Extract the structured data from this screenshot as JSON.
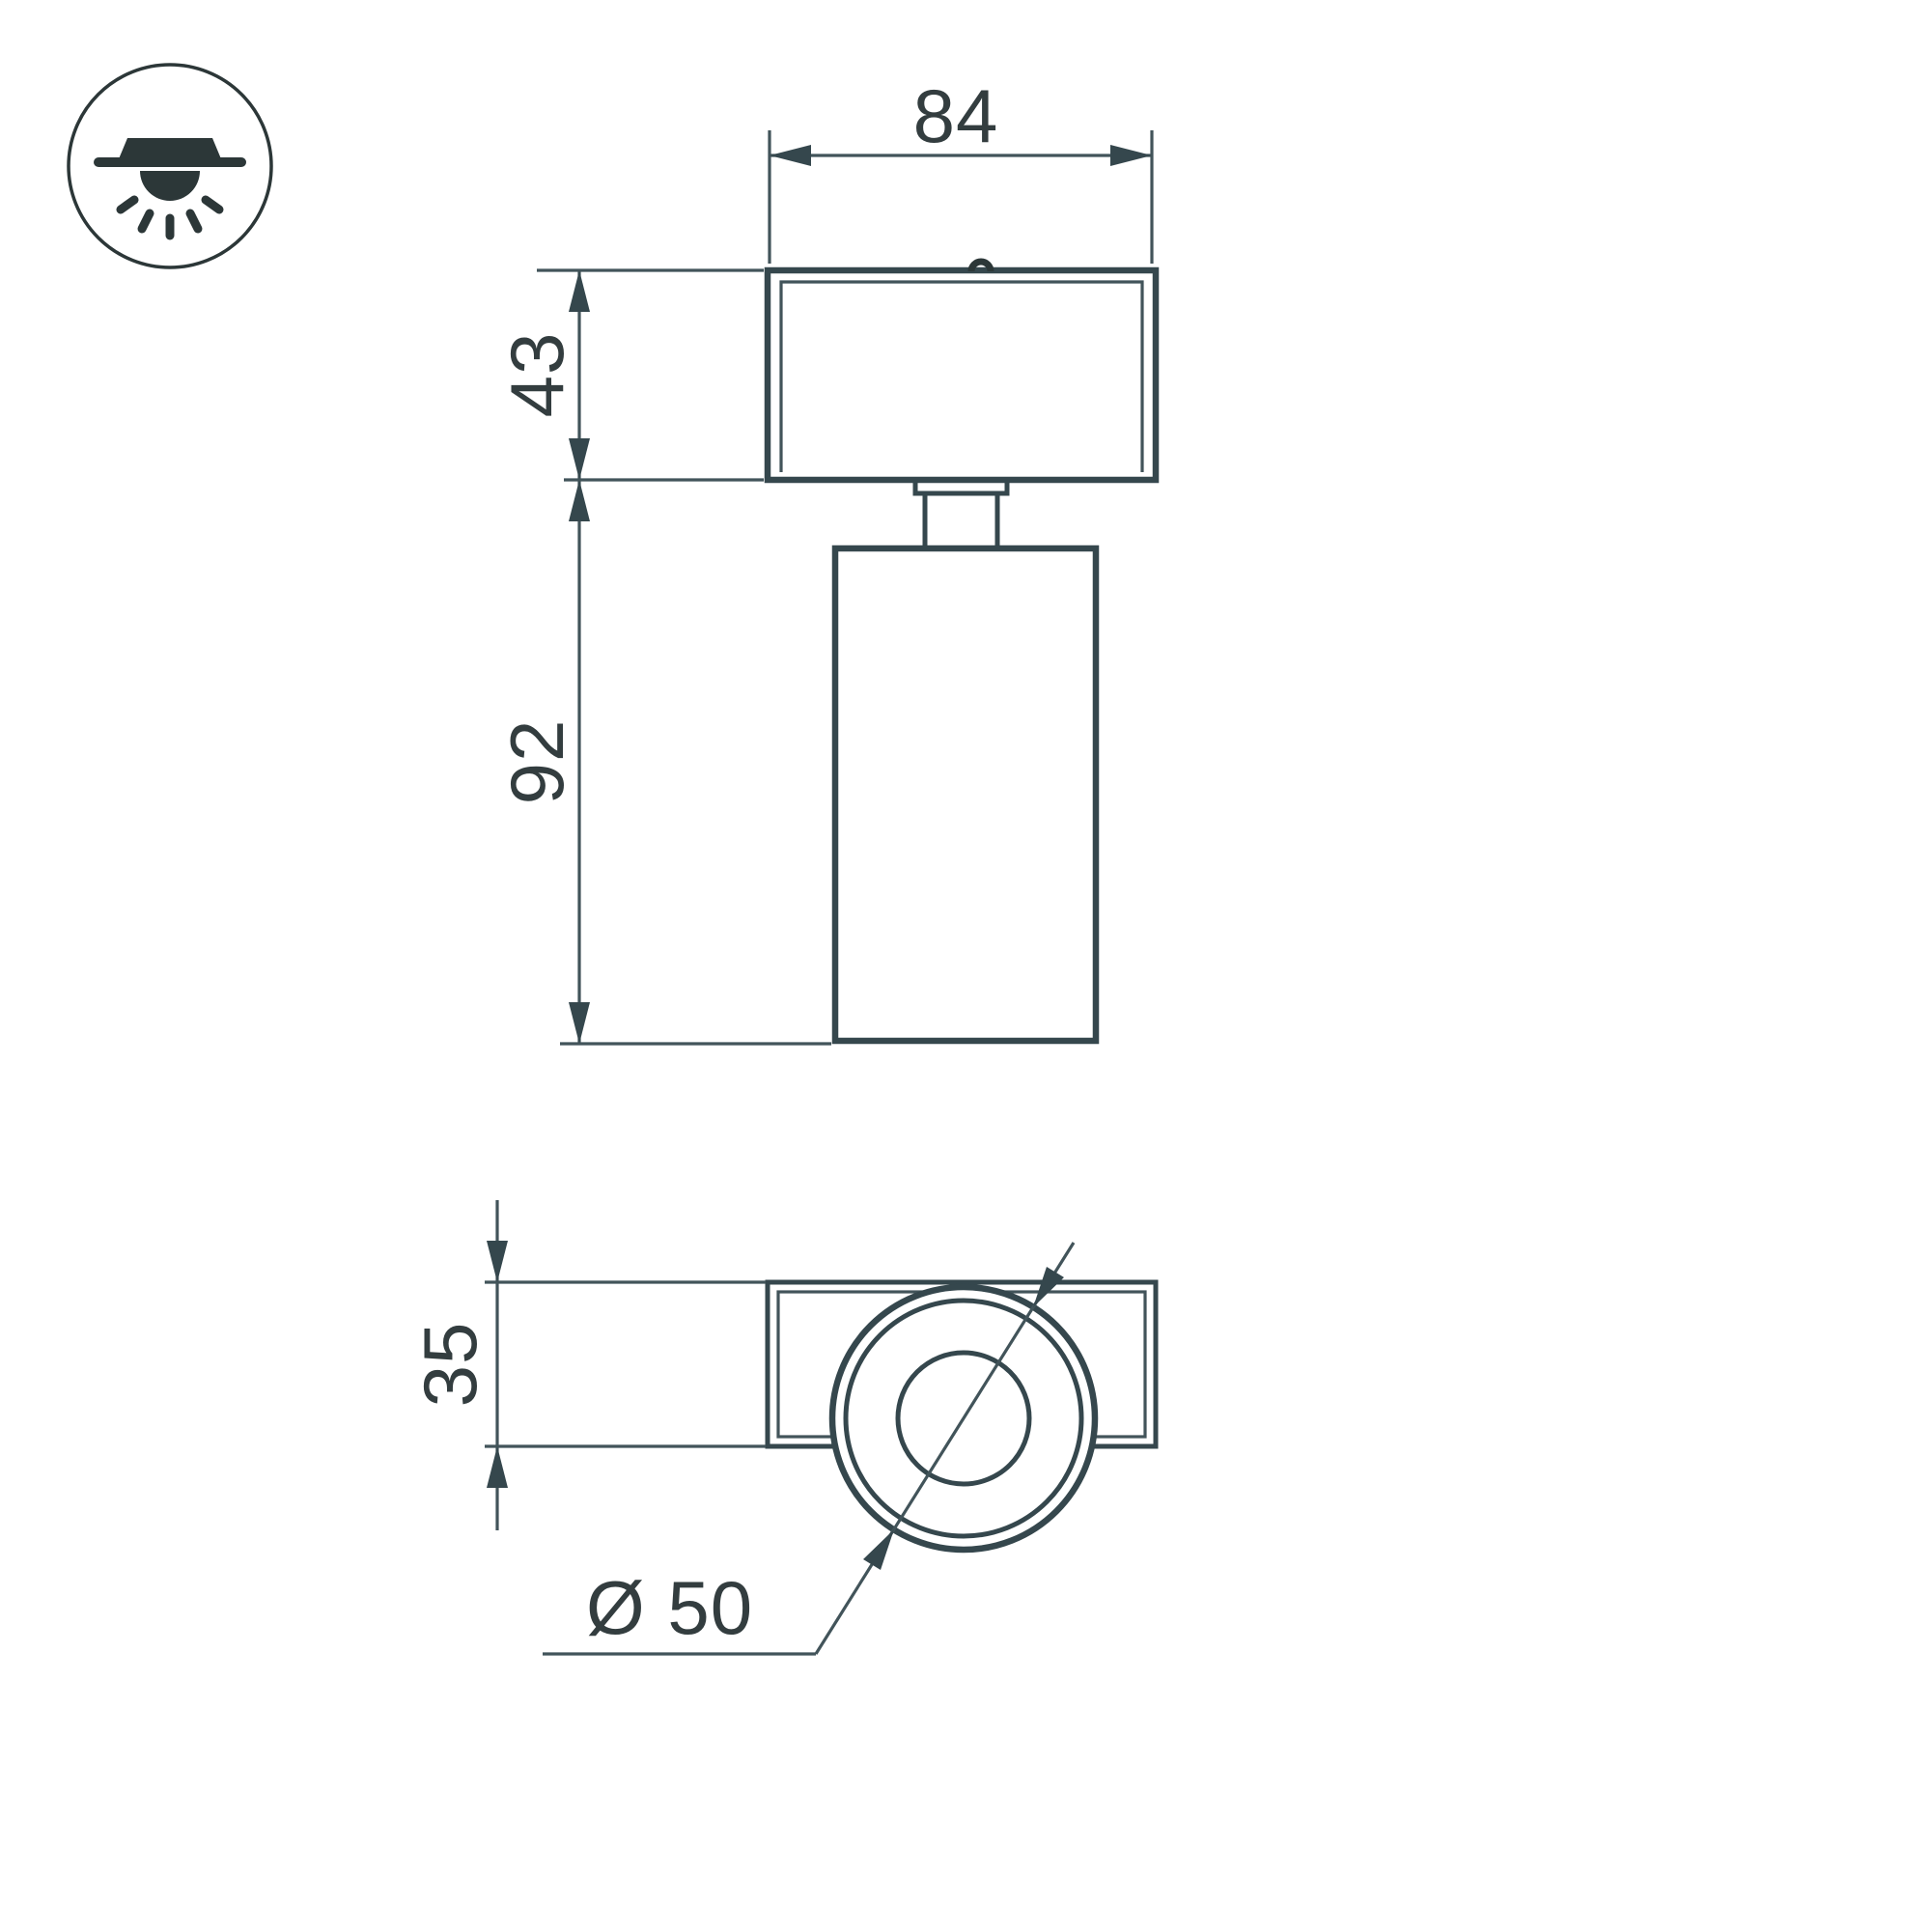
{
  "drawing": {
    "type": "technical-dimension-drawing",
    "subject": "surface-mounted ceiling spot luminaire, front and bottom orthographic views"
  },
  "mount_icon": {
    "name": "surface-ceiling-mount-light-icon"
  },
  "front_view": {
    "dimensions": {
      "width": {
        "label": "84",
        "value": 84,
        "orientation": "horizontal"
      },
      "adapter_height": {
        "label": "43",
        "value": 43,
        "orientation": "vertical"
      },
      "body_height": {
        "label": "92",
        "value": 92,
        "orientation": "vertical"
      }
    }
  },
  "plan_view": {
    "dimensions": {
      "depth": {
        "label": "35",
        "value": 35,
        "orientation": "vertical"
      },
      "diameter": {
        "label": "Ø 50",
        "value": 50,
        "orientation": "diagonal-leader"
      }
    }
  },
  "colors": {
    "line": "#35474d",
    "thin_line": "#42545a",
    "text_color": "#333d3f",
    "icon_color": "#2c3738",
    "background": "#ffffff"
  }
}
